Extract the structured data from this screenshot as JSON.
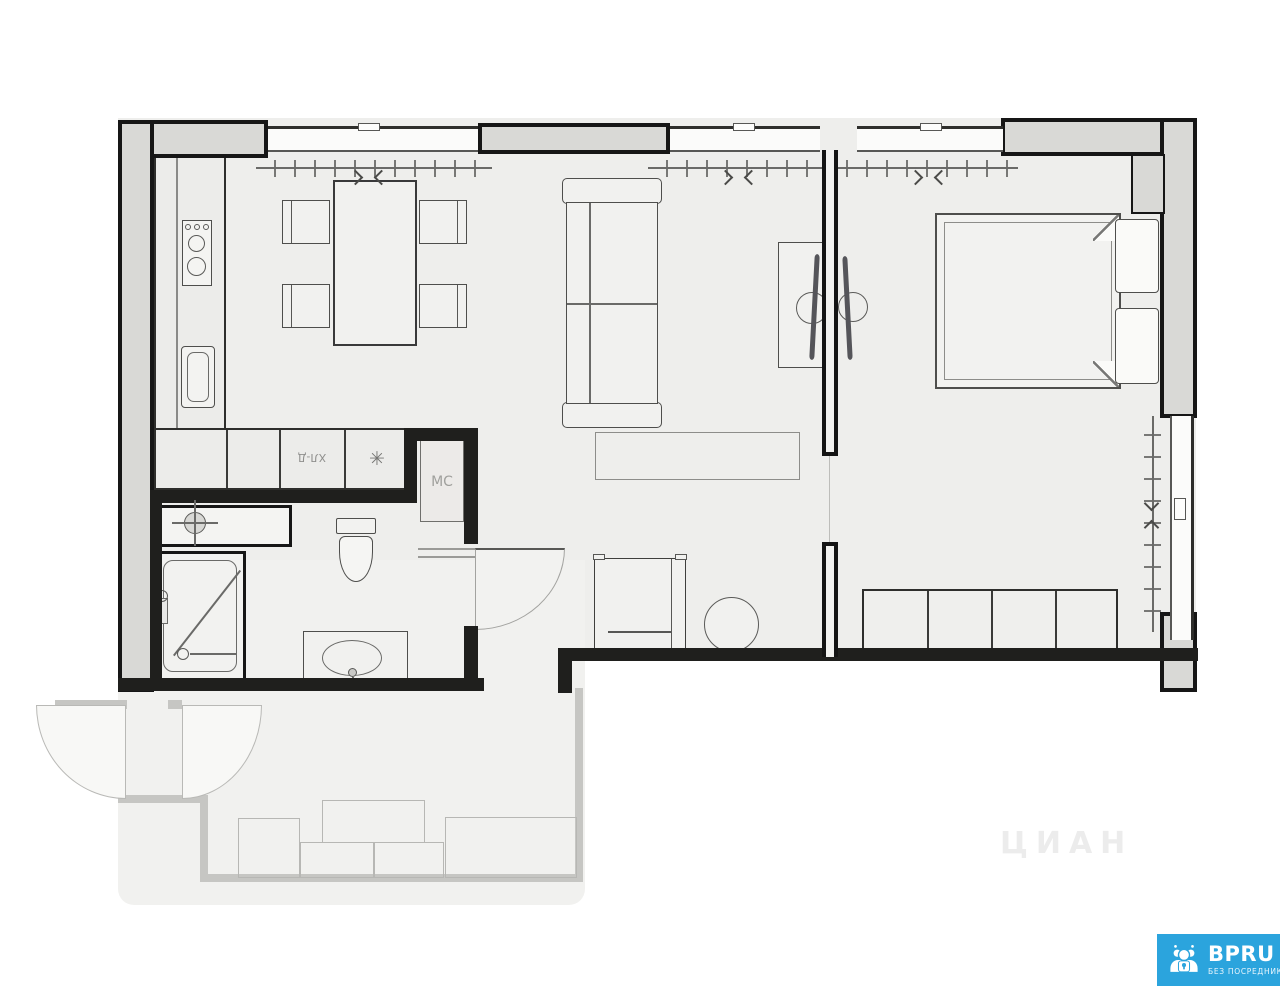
{
  "plan": {
    "labels": {
      "washer_closet": "МС",
      "fridge": "ХЛ-Д",
      "freezer_symbol": "✳"
    }
  },
  "watermark": {
    "text": "ЦИАН"
  },
  "logo": {
    "brand": "BPRU",
    "tagline": "БЕЗ ПОСРЕДНИКОВ",
    "bg_color": "#2ba4dd",
    "icon": "people-group-icon"
  },
  "colors": {
    "wall_outline": "#161616",
    "wall_fill": "#d9d9d6",
    "paper": "#eeeeec",
    "furniture_line": "#4e4e4c",
    "faded_line": "#b7b7b4"
  }
}
